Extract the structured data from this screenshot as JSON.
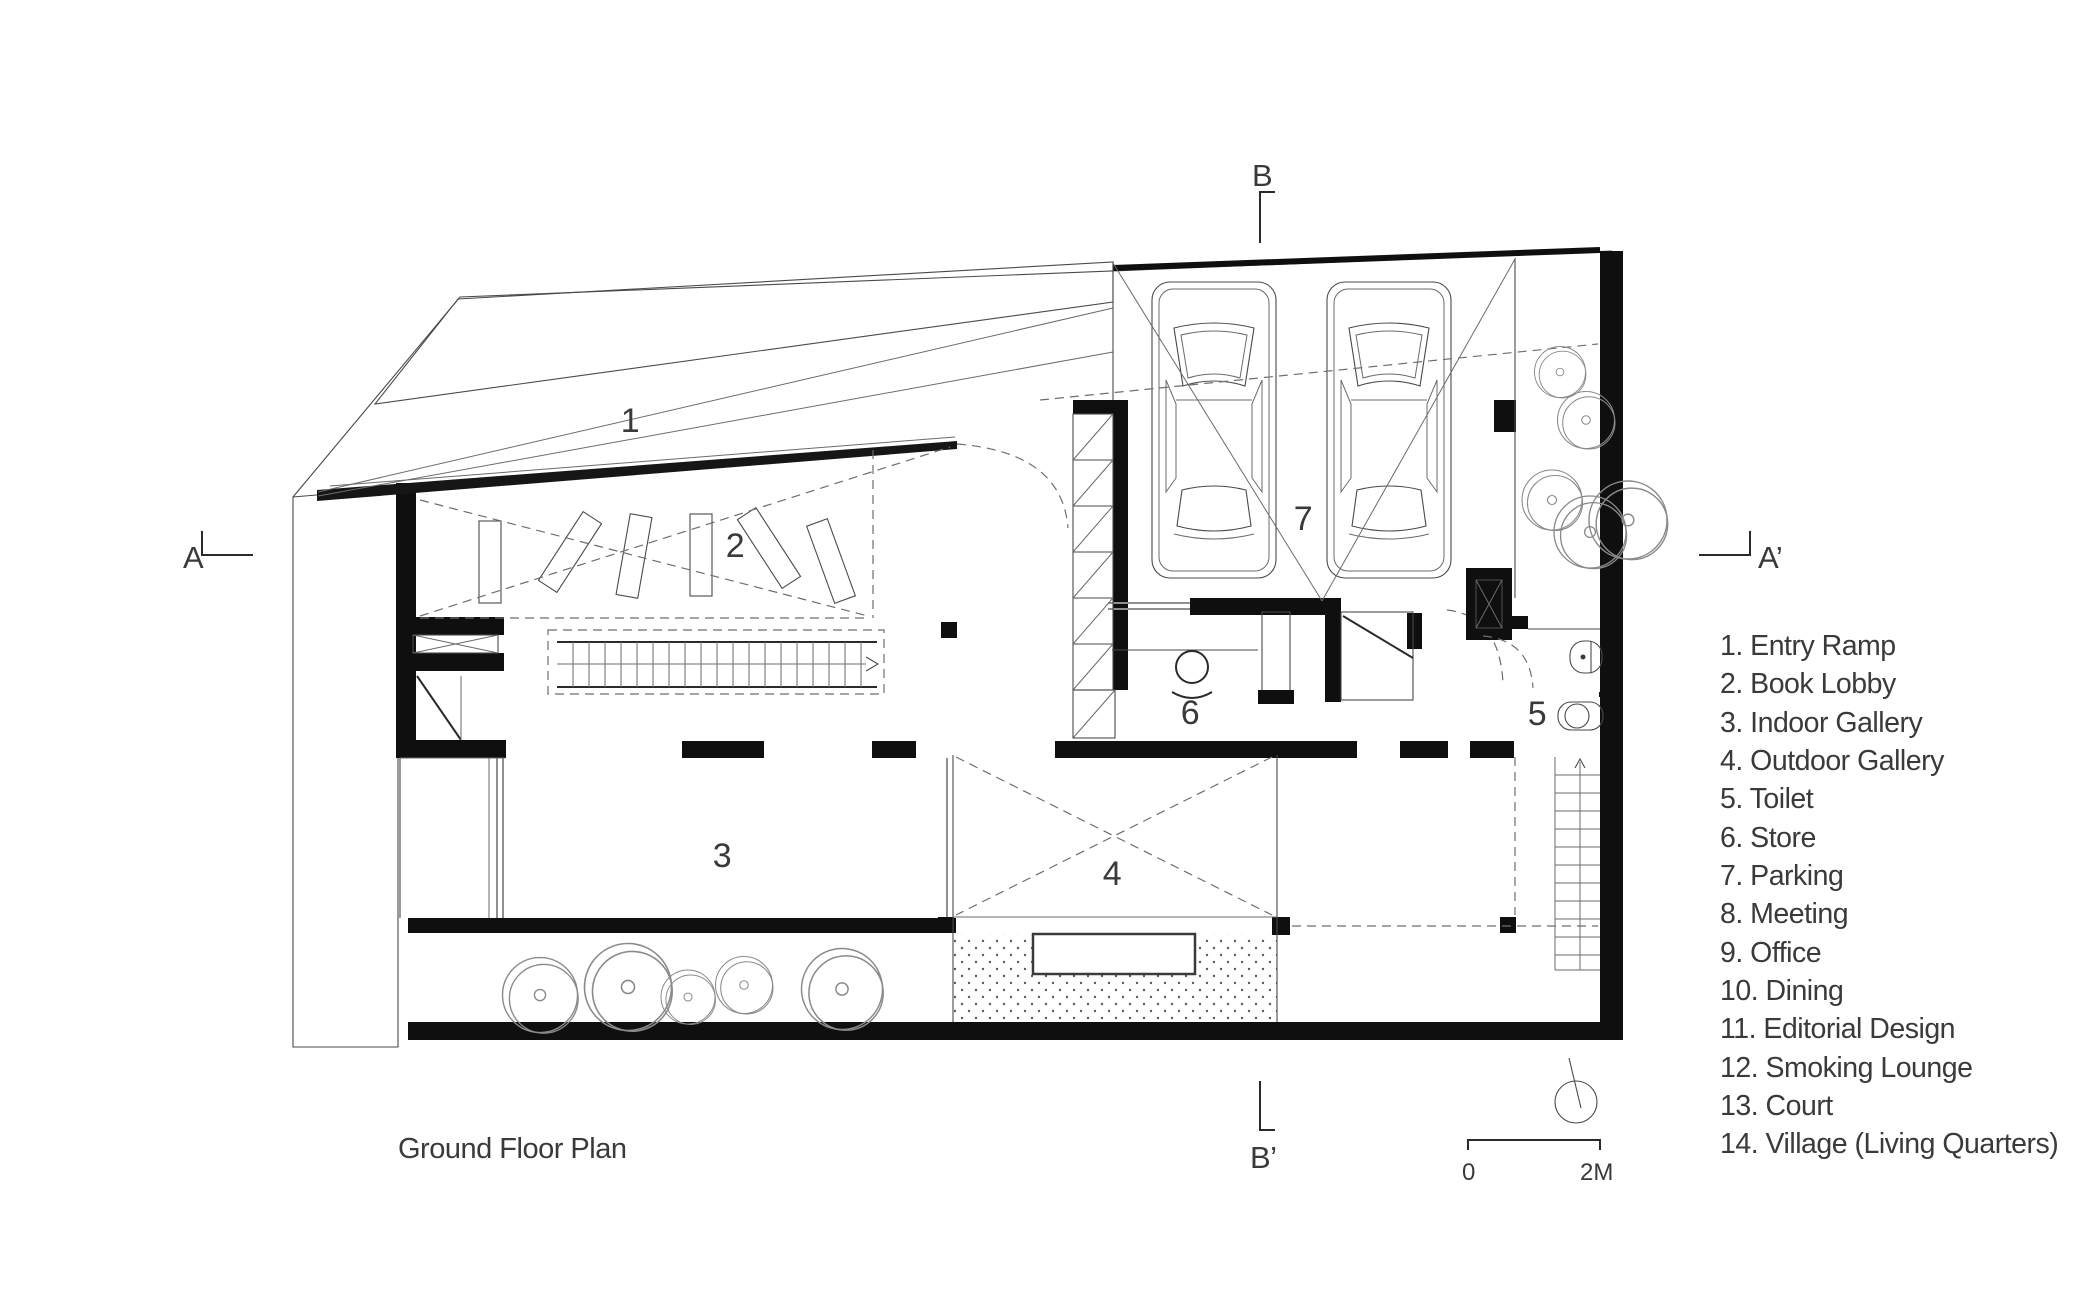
{
  "title": "Ground Floor Plan",
  "legend": {
    "items": [
      "1. Entry Ramp",
      "2. Book Lobby",
      "3. Indoor Gallery",
      "4. Outdoor Gallery",
      "5. Toilet",
      "6. Store",
      "7. Parking",
      "8. Meeting",
      "9. Office",
      "10. Dining",
      "11. Editorial Design",
      "12. Smoking Lounge",
      "13. Court",
      "14. Village (Living Quarters)"
    ]
  },
  "plan": {
    "rooms": {
      "entry_ramp": "1",
      "book_lobby": "2",
      "indoor_gallery": "3",
      "outdoor_gallery": "4",
      "toilet": "5",
      "store": "6",
      "parking": "7"
    },
    "sections": {
      "a": "A",
      "a_prime": "A’",
      "b": "B",
      "b_prime": "B’"
    },
    "scale": {
      "start": "0",
      "end": "2M"
    }
  },
  "colors": {
    "ink": "#0f0f0f",
    "line": "#4a4a4a",
    "text": "#3a3a3a"
  }
}
